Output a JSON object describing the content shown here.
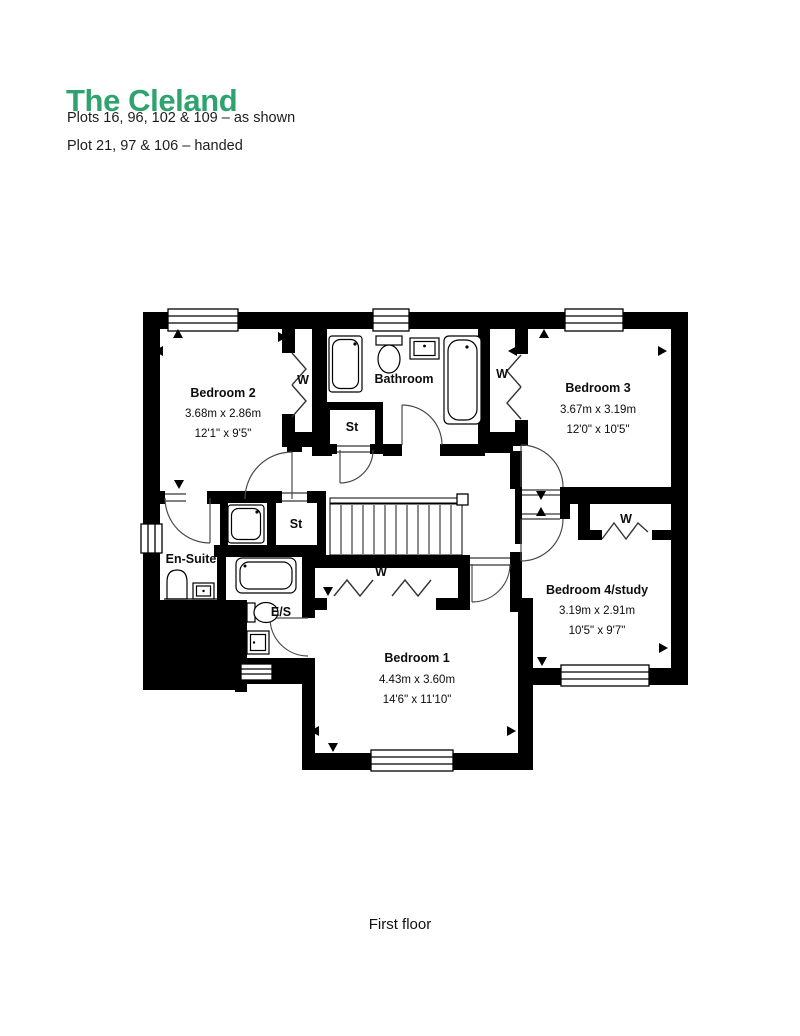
{
  "header": {
    "title": "The Cleland",
    "title_color": "#2ea36e",
    "subtitle_line1": "Plots 16, 96, 102 & 109 – as shown",
    "subtitle_line2": "Plot 21, 97 & 106 – handed"
  },
  "floorplan": {
    "labels": {
      "wardrobe": "W",
      "storage": "St"
    },
    "rooms": [
      {
        "name": "Bedroom 2",
        "metric": "3.68m x 2.86m",
        "imperial": "12'1\" x 9'5\""
      },
      {
        "name": "Bathroom"
      },
      {
        "name": "Bedroom 3",
        "metric": "3.67m x 3.19m",
        "imperial": "12'0\" x 10'5\""
      },
      {
        "name": "En-Suite"
      },
      {
        "name": "E/S"
      },
      {
        "name": "Bedroom 1",
        "metric": "4.43m x 3.60m",
        "imperial": "14'6\" x 11'10\""
      },
      {
        "name": "Bedroom 4/study",
        "metric": "3.19m x 2.91m",
        "imperial": "10'5\" x 9'7\""
      }
    ]
  },
  "footer": {
    "label": "First floor"
  }
}
